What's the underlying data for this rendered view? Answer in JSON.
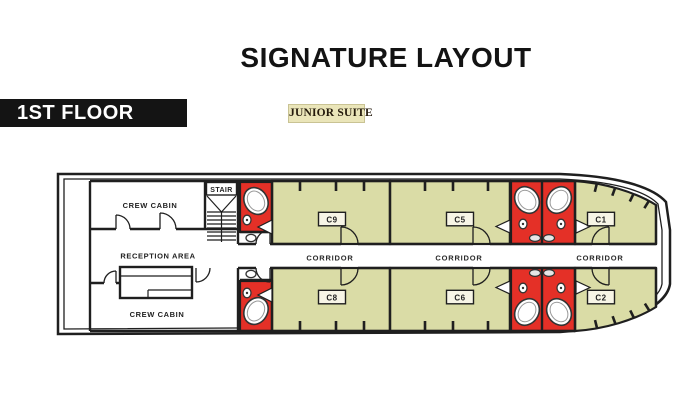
{
  "title": "SIGNATURE LAYOUT",
  "floor_label": "1ST FLOOR",
  "suite_label": "JUNIOR SUITE",
  "plan": {
    "rooms": {
      "crew_cabin_top": "CREW CABIN",
      "crew_cabin_bottom": "CREW CABIN",
      "reception": "RECEPTION AREA",
      "stair": "STAIR"
    },
    "corridors": [
      "CORRIDOR",
      "CORRIDOR",
      "CORRIDOR"
    ],
    "cabins": [
      {
        "id": "C9"
      },
      {
        "id": "C5"
      },
      {
        "id": "C1"
      },
      {
        "id": "C8"
      },
      {
        "id": "C6"
      },
      {
        "id": "C2"
      }
    ],
    "colors": {
      "cabin_fill": "#dadca6",
      "bathroom_fill": "#e43027",
      "wall": "#1f1f1f",
      "hull_fill": "#ffffff",
      "banner_bg": "#141414",
      "banner_text": "#ffffff",
      "suite_bg": "#eae5b9",
      "suite_text": "#241a0c",
      "label_box_fill": "#f7f5e6"
    }
  }
}
